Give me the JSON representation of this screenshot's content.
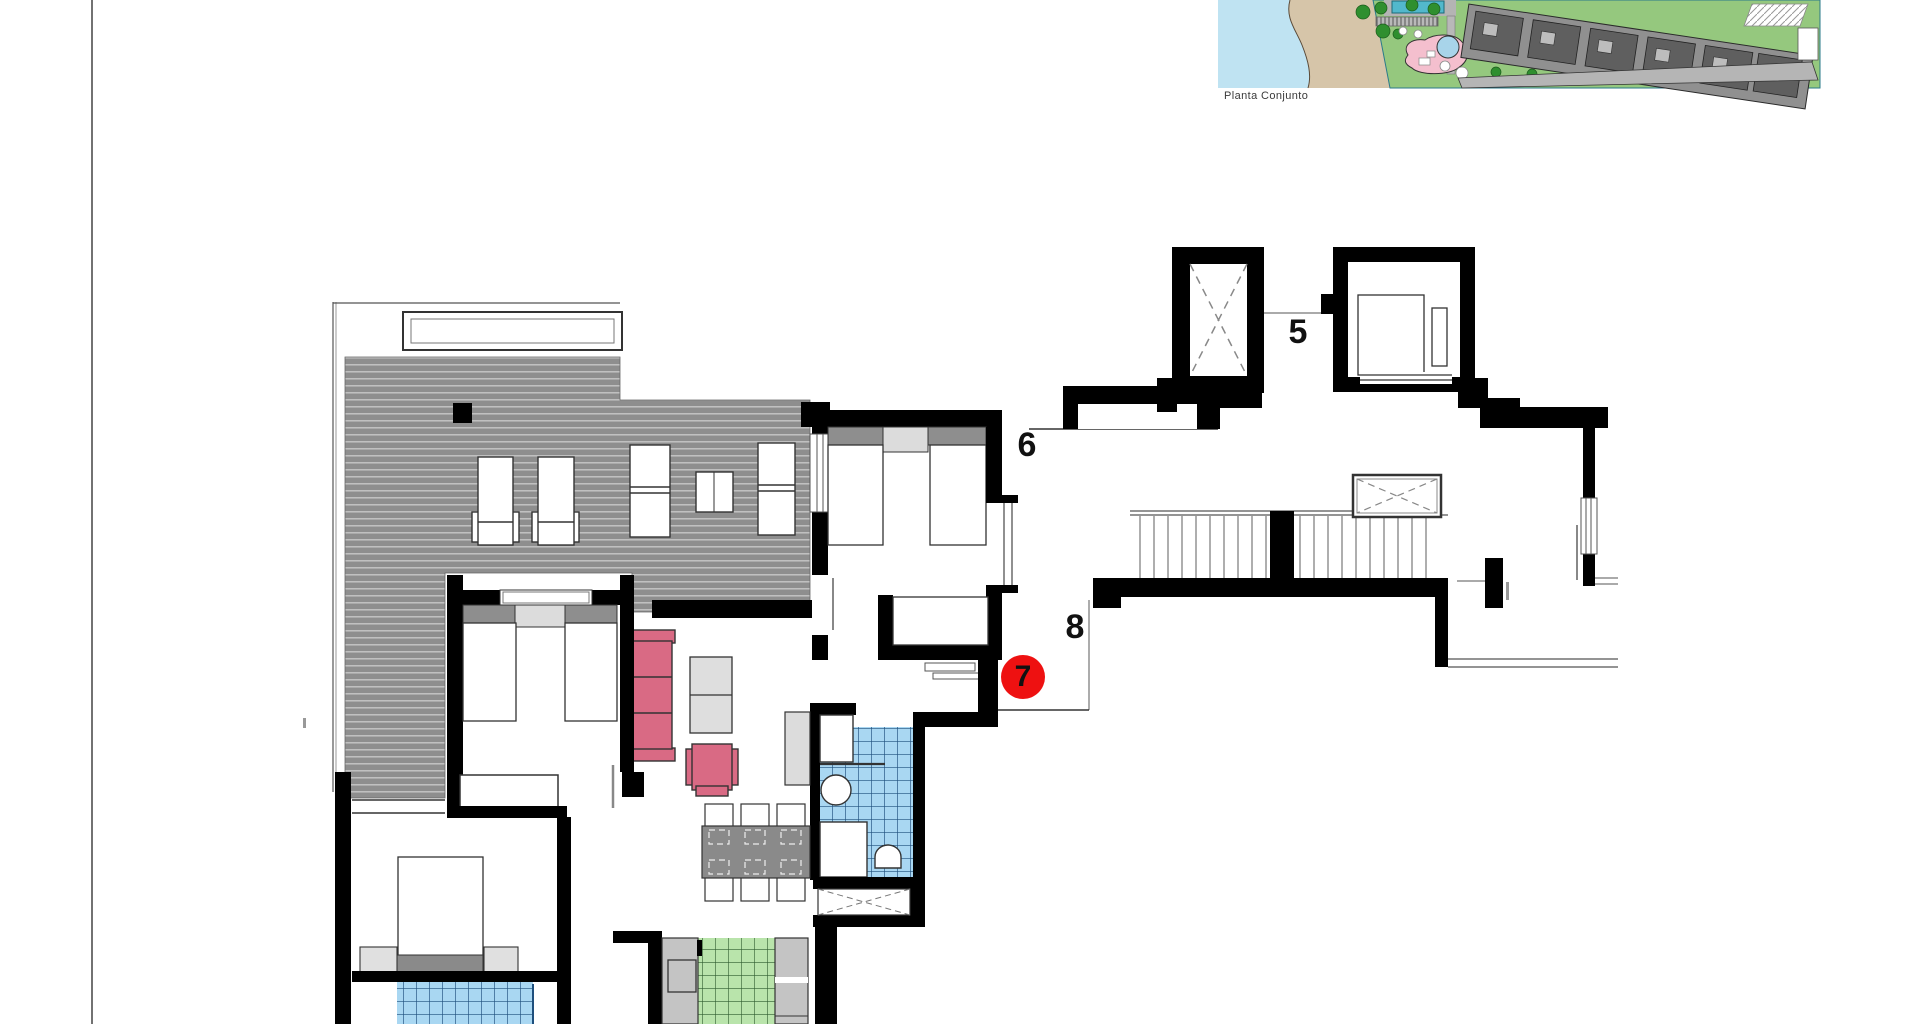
{
  "site_plan": {
    "caption": "Planta Conjunto"
  },
  "floor_plan": {
    "unit_labels": [
      {
        "id": "unit-5",
        "text": "5"
      },
      {
        "id": "unit-6",
        "text": "6"
      },
      {
        "id": "unit-8",
        "text": "8"
      }
    ],
    "selected_unit": {
      "text": "7",
      "badge_color": "#ee1111"
    }
  },
  "colors": {
    "wall": "#000000",
    "terrace": "#8e8e8e",
    "terrace_line": "#c6c6c6",
    "tile_blue": "#a9d7f2",
    "tile_blue_grid": "#1e4f7d",
    "tile_green": "#b9e4ab",
    "tile_green_grid": "#2e5c2e",
    "sofa_pink": "#d96a84",
    "table_gray": "#8a8a8a",
    "counter_gray": "#c4c4c4",
    "light_gray": "#dcdcdc",
    "badge_red": "#ee1111",
    "sea": "#bfe3f2",
    "sand": "#d6c5a9",
    "lawn": "#95c87e",
    "building_gray": "#909090",
    "building_dark": "#5f5f5f",
    "pool_pink": "#f4bfce",
    "pool_blue": "#a8d4ea",
    "pool_teal": "#52b8cc"
  }
}
